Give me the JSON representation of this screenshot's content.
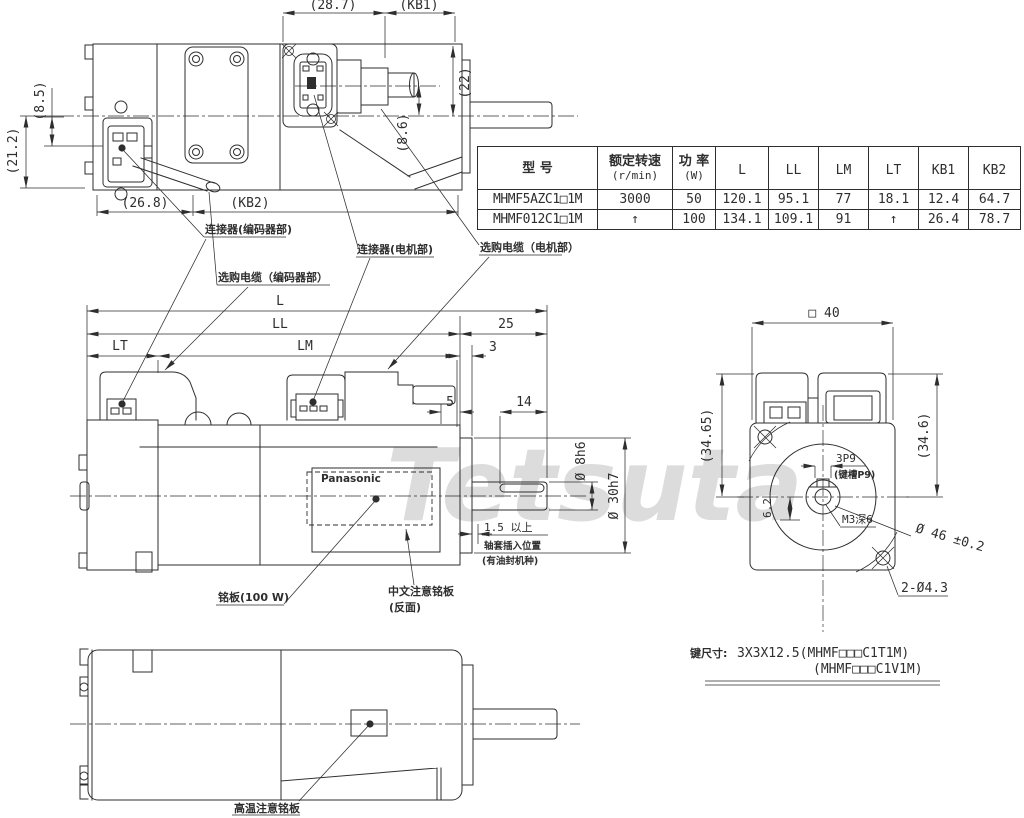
{
  "watermark": "Tetsuta",
  "table": {
    "headers": [
      [
        "型 号"
      ],
      [
        "额定转速",
        "(r/min)"
      ],
      [
        "功 率",
        "(W)"
      ],
      [
        "L"
      ],
      [
        "LL"
      ],
      [
        "LM"
      ],
      [
        "LT"
      ],
      [
        "KB1"
      ],
      [
        "KB2"
      ]
    ],
    "rows": [
      [
        "MHMF5AZC1□1M",
        "3000",
        "50",
        "120.1",
        "95.1",
        "77",
        "18.1",
        "12.4",
        "64.7"
      ],
      [
        "MHMF012C1□1M",
        "↑",
        "100",
        "134.1",
        "109.1",
        "91",
        "↑",
        "26.4",
        "78.7"
      ]
    ]
  },
  "top_view": {
    "w287": "(28.7)",
    "kb1": "(KB1)",
    "h85": "(8.5)",
    "h212": "(21.2)",
    "h22": "(22)",
    "h86": "(8.6)",
    "w268": "(26.8)",
    "kb2": "(KB2)"
  },
  "callouts": {
    "connector_encoder": "连接器(编码器部)",
    "cable_encoder": "选购电缆（编码器部）",
    "connector_motor": "连接器(电机部)",
    "cable_motor": "选购电缆（电机部）"
  },
  "side": {
    "L": "L",
    "LL": "LL",
    "n25": "25",
    "LT": "LT",
    "LM": "LM",
    "n3": "3",
    "n5": "5",
    "n14": "14",
    "shaft_dia": "Ø 8h6",
    "pilot_dia": "Ø 30h7",
    "min15": "1.5 以上",
    "sleeve": "轴套插入位置",
    "oil": "(有油封机种)",
    "nameplate": "铭板(100 W)",
    "cn_plate": "中文注意铭板",
    "back": "(反面)",
    "brand": "Panasonic"
  },
  "front": {
    "sq40": "□ 40",
    "h3465": "(34.65)",
    "h346": "(34.6)",
    "key": "3P9",
    "keyslot": "(键槽P9)",
    "tap": "M3深6",
    "d62": "6.2",
    "bc": "Ø 46 ±0.2",
    "holes": "2-Ø4.3"
  },
  "bottom": {
    "hot_label": "高温注意铭板"
  },
  "keynote": {
    "prefix": "键尺寸:",
    "line1": "3X3X12.5(MHMF□□□C1T1M)",
    "line2": "(MHMF□□□C1V1M)"
  }
}
